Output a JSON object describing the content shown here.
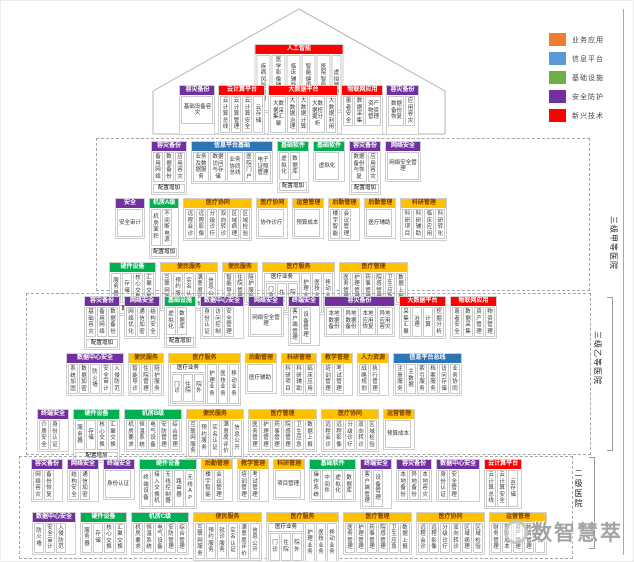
{
  "colors": {
    "purple": "#7030A0",
    "green": "#00B050",
    "yellow": "#FFC000",
    "blue": "#2E75B6",
    "red": "#FF0000"
  },
  "legend": {
    "items": [
      {
        "label": "业务应用",
        "color": "#ED7D31"
      },
      {
        "label": "信息平台",
        "color": "#5B9BD5"
      },
      {
        "label": "基础设施",
        "color": "#70AD47"
      },
      {
        "label": "安全防护",
        "color": "#7030A0"
      },
      {
        "label": "新兴技术",
        "color": "#FF0000"
      }
    ]
  },
  "labels": {
    "tier1": "三级甲等医院",
    "tier2": "三级乙等医院",
    "tier3": "二级医院"
  },
  "watermark": {
    "text": "数智慧萃"
  },
  "house": {
    "ai": {
      "h": "人工智能",
      "c": "red",
      "items": [
        "疾病风险预测",
        "医学影像辅助检测",
        "临床辅助诊疗",
        "智能健康管理",
        "医院智能管理",
        "虚拟管理"
      ]
    },
    "platforms": [
      {
        "h": "容灾备份",
        "c": "purple",
        "items": [
          "基础设备容灾"
        ]
      },
      {
        "h": "云计算平台",
        "c": "red",
        "items": [
          "云计算总线",
          "云计算管理",
          "云计算安全",
          "云存储"
        ]
      },
      {
        "h": "大数据平台",
        "c": "red",
        "items": [
          "大数据采集汇聚",
          "大数据治理",
          "大数据计算",
          "大数据挖掘分析",
          "大数据利用"
        ]
      },
      {
        "h": "物联网应用",
        "c": "red",
        "items": [
          "患者安全",
          "数据采集",
          "资产物资管理"
        ]
      },
      {
        "h": "容灾备份",
        "c": "purple",
        "items": [
          "数据备份恢复",
          "应用容灾"
        ]
      }
    ]
  },
  "tiers": [
    {
      "id": "tier1",
      "rows": [
        [
          {
            "h": "容灾备份",
            "c": "purple",
            "items": [
              "备用网络",
              "数据备份",
              "应用容灾"
            ],
            "footer": "配置增加"
          },
          {
            "h": "信息平台基础",
            "c": "blue",
            "items": [
              "业务及数据服务",
              "数据访问与存储",
              "业务协同总线",
              "医院门户",
              "电子证照管理"
            ]
          },
          {
            "h": "基础软件",
            "c": "green",
            "items": [
              "虚拟化",
              "数据库"
            ],
            "footer": "配置增加"
          },
          {
            "h": "基础软件",
            "c": "green",
            "items": [
              "虚拟化"
            ]
          },
          {
            "h": "容灾备份",
            "c": "purple",
            "items": [
              "数据备份与恢复",
              "应用容灾"
            ],
            "footer": "配置增加"
          },
          {
            "h": "网络安全",
            "c": "purple",
            "items": [
              "网络安全管理"
            ]
          }
        ],
        [
          {
            "h": "安全",
            "c": "purple",
            "items": [
              "安全审计"
            ]
          },
          {
            "h": "机房A级",
            "c": "green",
            "items": [
              "机房面积",
              "不间断电源"
            ],
            "footer": "配置增加"
          },
          {
            "h": "医疗协同",
            "c": "yellow",
            "items": [
              "远程会诊",
              "远程影像",
              "分级诊疗",
              "双向转诊",
              "区域病理",
              "区域检验"
            ]
          },
          {
            "h": "医疗协同",
            "c": "yellow",
            "items": [
              "协作诊疗"
            ]
          },
          {
            "h": "运营管理",
            "c": "yellow",
            "items": [
              "预算成本"
            ]
          },
          {
            "h": "后勤管理",
            "c": "yellow",
            "items": [
              "楼宇智能",
              "会议管理"
            ]
          },
          {
            "h": "后勤管理",
            "c": "yellow",
            "items": [
              "医疗辅助"
            ]
          },
          {
            "h": "科研管理",
            "c": "yellow",
            "items": [
              "科研项目",
              "科研辅助",
              "临床应用",
              "科研转化"
            ]
          }
        ],
        [
          {
            "h": "硬件设备",
            "c": "green",
            "items": [
              "服务器",
              "存储",
              "核心交换",
              "汇聚交换"
            ],
            "footer": "配置增加"
          },
          {
            "h": "便民服务",
            "c": "yellow",
            "items": [
              "互联网服务",
              "预约服务",
              "实名认证",
              "满意度评价",
              "信息公开"
            ]
          },
          {
            "h": "便民服务",
            "c": "yellow",
            "items": [
              "智能导诊",
              "住院管理",
              "陪护服务"
            ]
          },
          {
            "h": "医疗服务",
            "c": "yellow",
            "items": [
              {
                "label": "医疗业务",
                "subs": [
                  "门急诊",
                  "住院",
                  "院外"
                ]
              },
              "护理业务",
              "医技业务",
              "移动业务"
            ]
          },
          {
            "h": "医疗管理",
            "c": "yellow",
            "items": [
              "医务管理",
              "护理管理",
              "药事管理",
              "院感管理",
              "卫生应急",
              "数据上报"
            ]
          }
        ]
      ]
    },
    {
      "id": "tier2",
      "rows": [
        [
          {
            "h": "容灾备份",
            "c": "purple",
            "items": [
              "基础容灾",
              "备用网络",
              "数据备份"
            ],
            "footer": "配置增加"
          },
          {
            "h": "网络安全",
            "c": "purple",
            "items": [
              "网络优化",
              "通信加密",
              "结构安全"
            ]
          },
          {
            "h": "基础设施",
            "c": "green",
            "items": [
              "虚拟化",
              "数据库"
            ],
            "footer": "配置增加"
          },
          {
            "h": "数据中心安全",
            "c": "purple",
            "items": [
              "身份认证",
              "访问控制",
              "安全管理"
            ]
          },
          {
            "h": "网络安全",
            "c": "purple",
            "items": [
              "网络安全管理"
            ]
          },
          {
            "h": "终端安全",
            "c": "purple",
            "items": [
              "客户端管理",
              "设备管理"
            ]
          },
          {
            "h": "容灾备份",
            "c": "purple",
            "items": [
              "本地数据备份",
              "异地数据备份",
              "本地应用恢复",
              "异地应用容灾"
            ]
          },
          {
            "h": "大数据平台",
            "c": "red",
            "items": [
              "采集汇聚",
              "治理",
              "计算",
              "挖掘分析"
            ]
          },
          {
            "h": "物联网应用",
            "c": "red",
            "items": [
              "患者安全",
              "数据采集",
              "资产管理",
              "物资管理"
            ]
          }
        ],
        [
          {
            "h": "数据中心安全",
            "c": "purple",
            "items": [
              "系统加固",
              "数据加密",
              "防火墙",
              "安全审计",
              "入侵防范"
            ]
          },
          {
            "h": "便民服务",
            "c": "yellow",
            "items": [
              "智能导诊",
              "住院管理",
              "陪护服务"
            ]
          },
          {
            "h": "医疗服务",
            "c": "yellow",
            "items": [
              {
                "label": "医疗业务",
                "subs": [
                  "门诊",
                  "住院",
                  "院外"
                ]
              },
              "护理业务",
              "医技业务",
              "移动业务"
            ]
          },
          {
            "h": "后勤管理",
            "c": "yellow",
            "items": [
              "医疗辅助"
            ]
          },
          {
            "h": "科研管理",
            "c": "yellow",
            "items": [
              "科研项目",
              "科研辅助",
              "临床应用"
            ]
          },
          {
            "h": "教学管理",
            "c": "yellow",
            "items": [
              "培训管理",
              "考试管理"
            ]
          },
          {
            "h": "人力资源",
            "c": "yellow",
            "items": [
              "战略规划",
              "执行管理"
            ]
          },
          {
            "h": "信息平台总线",
            "c": "blue",
            "items": [
              "注册服务",
              "主数据",
              "索引服务",
              "档案服务",
              "访问存储",
              "业务协同"
            ]
          }
        ],
        [
          {
            "h": "终端安全",
            "c": "purple",
            "items": [
              "介质安全",
              "身份认证"
            ]
          },
          {
            "h": "硬件设备",
            "c": "green",
            "items": [
              "服务器",
              "存储",
              "核心交换",
              "汇聚交换"
            ],
            "footer": "配置增加"
          },
          {
            "h": "机房B级",
            "c": "green",
            "items": [
              "机房要求",
              "恒温系统",
              "电气设备",
              "安防管理",
              "综合管理"
            ]
          },
          {
            "h": "便民服务",
            "c": "yellow",
            "items": [
              "互联网服务",
              "预约服务",
              "实名认证",
              "满意度评价",
              "信息公开"
            ]
          },
          {
            "h": "医疗管理",
            "c": "yellow",
            "items": [
              "医务管理",
              "护理管理",
              "药事管理",
              "院感管理",
              "卫生应急",
              "数据上报"
            ]
          },
          {
            "h": "医疗协同",
            "c": "yellow",
            "items": [
              "远程会诊",
              "远程影像",
              "分级诊疗",
              "双向转诊",
              "区域检验"
            ]
          },
          {
            "h": "运营管理",
            "c": "yellow",
            "items": [
              "预算成本"
            ]
          }
        ]
      ]
    },
    {
      "id": "tier3",
      "rows": [
        [
          {
            "h": "容灾备份",
            "c": "purple",
            "items": [
              "网络容灾",
              "备份恢复"
            ]
          },
          {
            "h": "网络安全",
            "c": "purple",
            "items": [
              "结构安全",
              "通信加密"
            ]
          },
          {
            "h": "终端安全",
            "c": "purple",
            "items": [
              "身份认证"
            ]
          },
          {
            "h": "硬件设备",
            "c": "green",
            "items": [
              "终端设备",
              "接入交换机",
              "无线控制器",
              "路由器",
              "无线AP"
            ]
          },
          {
            "h": "后勤管理",
            "c": "yellow",
            "items": [
              "楼宇智能",
              "会议管理"
            ]
          },
          {
            "h": "教学管理",
            "c": "yellow",
            "items": [
              "培训管理",
              "考试管理"
            ]
          },
          {
            "h": "科研管理",
            "c": "yellow",
            "items": [
              "项目管理"
            ]
          },
          {
            "h": "基础软件",
            "c": "green",
            "items": [
              "操作系统",
              "中间件",
              "虚拟化",
              "数据库"
            ]
          },
          {
            "h": "终端安全",
            "c": "purple",
            "items": [
              "客户端管理",
              "设备管理"
            ]
          },
          {
            "h": "容灾备份",
            "c": "purple",
            "items": [
              "本地备份",
              "异地备份",
              "本地容灾"
            ]
          },
          {
            "h": "数据中心安全",
            "c": "purple",
            "items": [
              "身份认证",
              "安全管理"
            ]
          },
          {
            "h": "云计算平台",
            "c": "red",
            "items": [
              "云计算总线",
              "云计算安全",
              "云存储"
            ]
          }
        ],
        [
          {
            "h": "数据中心安全",
            "c": "purple",
            "items": [
              "防火墙",
              "安全审计",
              "入侵防范"
            ]
          },
          {
            "h": "硬件设备",
            "c": "green",
            "items": [
              "服务器",
              "存储",
              "核心交换",
              "汇聚交换"
            ]
          },
          {
            "h": "机房C级",
            "c": "green",
            "items": [
              "机房要求",
              "恒温系统",
              "电气设备",
              "安防管理",
              "综合管理"
            ]
          },
          {
            "h": "便民服务",
            "c": "yellow",
            "items": [
              "互联网服务",
              "预约服务",
              "就诊服务",
              "实名认证",
              "满意度评价",
              "信息公开"
            ]
          },
          {
            "h": "医疗服务",
            "c": "yellow",
            "items": [
              {
                "label": "医疗业务",
                "subs": [
                  "门诊",
                  "住院",
                  "院外"
                ]
              },
              "护理业务",
              "医技业务",
              "移动业务"
            ]
          },
          {
            "h": "医疗管理",
            "c": "yellow",
            "items": [
              "医务管理",
              "护理管理",
              "药事管理",
              "院感管理",
              "卫生应急",
              "数据上报"
            ]
          },
          {
            "h": "医疗协同",
            "c": "yellow",
            "items": [
              "远程会诊",
              "远程影像",
              "分级诊疗",
              "双向转诊",
              "区域病理",
              "区域检验"
            ]
          },
          {
            "h": "运营管理",
            "c": "yellow",
            "items": [
              "财务管理",
              "预算成本",
              "资产管理",
              "物资管理",
              "审计"
            ]
          }
        ]
      ]
    }
  ]
}
